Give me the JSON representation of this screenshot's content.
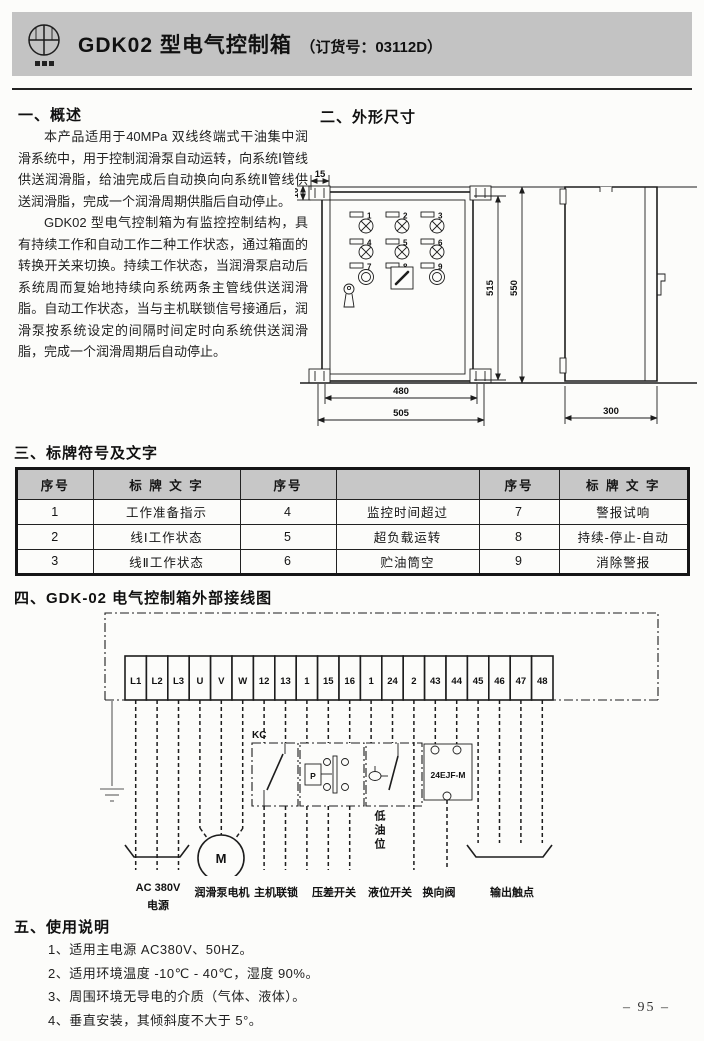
{
  "header": {
    "title": "GDK02 型电气控制箱",
    "subtitle": "（订货号：03112D）"
  },
  "overview": {
    "heading": "一、概述",
    "p1": "本产品适用于40MPa 双线终端式干油集中润滑系统中，用于控制润滑泵自动运转，向系统Ⅰ管线供送润滑脂，给油完成后自动换向向系统Ⅱ管线供送润滑脂，完成一个润滑周期供脂后自动停止。",
    "p2": "GDK02 型电气控制箱为有监控控制结构，具有持续工作和自动工作二种工作状态，通过箱面的转换开关来切换。持续工作状态，当润滑泵启动后系统周而复始地持续向系统两条主管线供送润滑脂。自动工作状态，当与主机联锁信号接通后，润滑泵按系统设定的间隔时间定时向系统供送润滑脂，完成一个润滑周期后自动停止。"
  },
  "dimensions": {
    "heading": "二、外形尺寸",
    "panel_numbers": [
      "1",
      "2",
      "3",
      "4",
      "5",
      "6",
      "7",
      "8",
      "9"
    ],
    "dim_15": "15",
    "dim_10": "10",
    "dim_515": "515",
    "dim_550": "550",
    "dim_480": "480",
    "dim_505": "505",
    "dim_300": "300"
  },
  "labels_table": {
    "heading": "三、标牌符号及文字",
    "headers": [
      "序号",
      "标 牌 文 字",
      "序号",
      "",
      "序号",
      "标 牌 文 字"
    ],
    "rows": [
      [
        "1",
        "工作准备指示",
        "4",
        "监控时间超过",
        "7",
        "警报试响"
      ],
      [
        "2",
        "线Ⅰ工作状态",
        "5",
        "超负载运转",
        "8",
        "持续-停止-自动"
      ],
      [
        "3",
        "线Ⅱ工作状态",
        "6",
        "贮油筒空",
        "9",
        "消除警报"
      ]
    ]
  },
  "wiring": {
    "heading": "四、GDK-02 电气控制箱外部接线图",
    "terminals": [
      "L1",
      "L2",
      "L3",
      "U",
      "V",
      "W",
      "12",
      "13",
      "1",
      "15",
      "16",
      "1",
      "24",
      "2",
      "43",
      "44",
      "45",
      "46",
      "47",
      "48"
    ],
    "kc": "KC",
    "motor": "M",
    "pressure": "P",
    "valve": "24EJF-M",
    "low_oil": "低油位",
    "labels": {
      "power_1": "AC 380V",
      "power_2": "电源",
      "motor": "润滑泵电机",
      "interlock": "主机联锁",
      "pressure": "压差开关",
      "level": "液位开关",
      "valve": "换向阀",
      "output": "输出触点"
    }
  },
  "usage": {
    "heading": "五、使用说明",
    "items": [
      "1、适用主电源 AC380V、50HZ。",
      "2、适用环境温度 -10℃ - 40℃，湿度 90%。",
      "3、周围环境无导电的介质（气体、液体）。",
      "4、垂直安装，其倾斜度不大于 5°。"
    ]
  },
  "footer": {
    "page": "– 95 –"
  }
}
